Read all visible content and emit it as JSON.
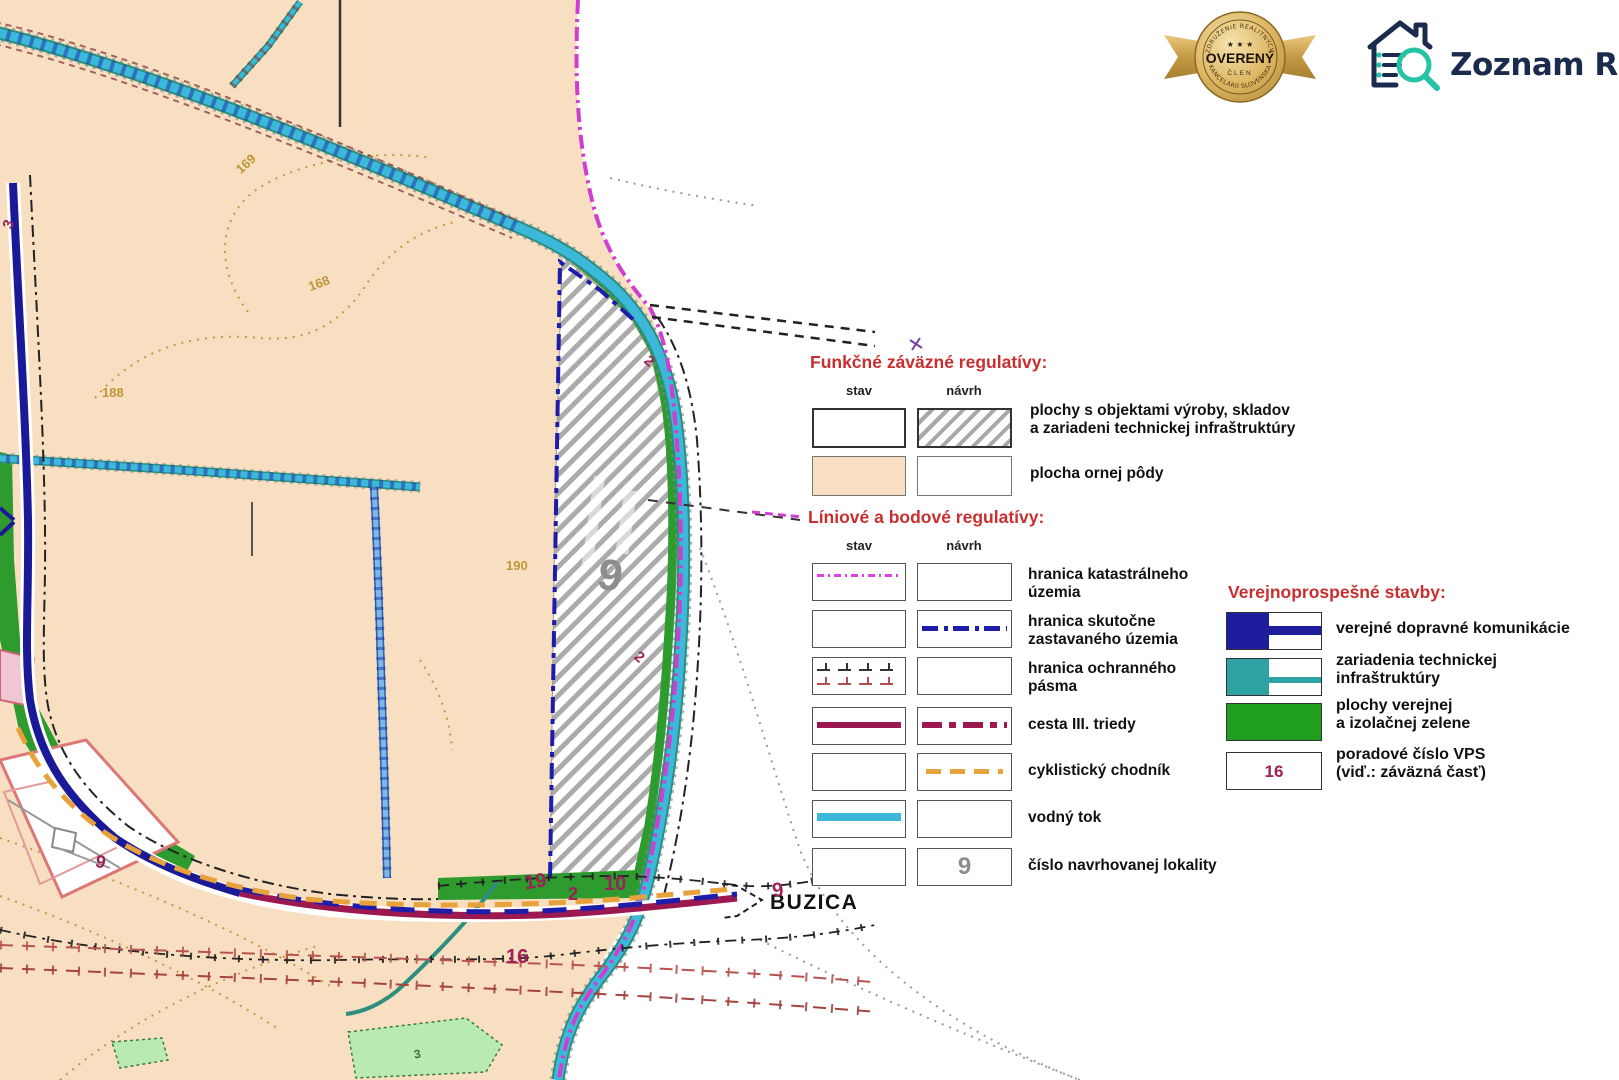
{
  "branding": {
    "badge": {
      "arc_top": "ZDRUŽENIE REALITNÝCH",
      "stars": "★ ★ ★",
      "title": "OVERENÝ",
      "member": "ČLEN",
      "arc_bottom": "KANCELÁRIÍ SLOVENSKA"
    },
    "logo": {
      "brand": "Zoznam Realít",
      "country": "SK"
    }
  },
  "legend": {
    "functional": {
      "title": "Funkčné záväzné regulatívy:",
      "columns": {
        "stav": "stav",
        "navrh": "návrh"
      },
      "rows": [
        {
          "label_line1": "plochy s objektami výroby, skladov",
          "label_line2": "a zariadeni technickej infraštruktúry"
        },
        {
          "label_line1": "plocha ornej pôdy",
          "label_line2": ""
        }
      ]
    },
    "linear": {
      "title": "Líniové a bodové regulatívy:",
      "columns": {
        "stav": "stav",
        "navrh": "návrh"
      },
      "rows": [
        {
          "label_line1": "hranica katastrálneho",
          "label_line2": "územia"
        },
        {
          "label_line1": "hranica skutočne",
          "label_line2": "zastavaného územia"
        },
        {
          "label_line1": "hranica ochranného",
          "label_line2": "pásma"
        },
        {
          "label_line1": "cesta III. triedy",
          "label_line2": ""
        },
        {
          "label_line1": "cyklistický chodník",
          "label_line2": ""
        },
        {
          "label_line1": "vodný tok",
          "label_line2": ""
        },
        {
          "label_line1": "číslo navrhovanej lokality",
          "label_line2": "",
          "symbol_text": "9"
        }
      ]
    },
    "public_works": {
      "title": "Verejnoprospešné stavby:",
      "rows": [
        {
          "label_line1": "verejné dopravné komunikácie",
          "label_line2": ""
        },
        {
          "label_line1": "zariadenia technickej",
          "label_line2": "infraštruktúry"
        },
        {
          "label_line1": "plochy verejnej",
          "label_line2": "a izolačnej zelene"
        },
        {
          "label_line1": "poradové číslo VPS",
          "label_line2": "(viď.: záväzná časť)",
          "symbol_text": "16"
        }
      ]
    }
  },
  "map": {
    "place_label": "BUZICA",
    "locality_number": "9",
    "numbers": {
      "n19": "19",
      "n2_road": "2",
      "n10": "10",
      "n9_road": "9",
      "n16": "16",
      "n9_left": "9",
      "n3_left": "3",
      "n2_edge_upper": "2",
      "n2_edge_lower": "2",
      "n3_green": "3"
    },
    "contours": {
      "c169": "169",
      "c168": "168",
      "c188": "188",
      "c190": "190"
    }
  },
  "colors": {
    "orna_poda": "#f9dfc1",
    "vodny_tok": "#3ab7d9",
    "cesta_iii": "#9c1950",
    "cyklo": "#e8a23c",
    "doprava_vps": "#1d1d9e",
    "technicka_vps": "#2fa3a3",
    "zelen_vps": "#1f9e1f",
    "hranica_kat": "#e040e0",
    "heading_red": "#c92f2f",
    "logo_navy": "#1b2b4d",
    "logo_teal": "#25c4a4",
    "badge_gold": "#d9b05e"
  }
}
